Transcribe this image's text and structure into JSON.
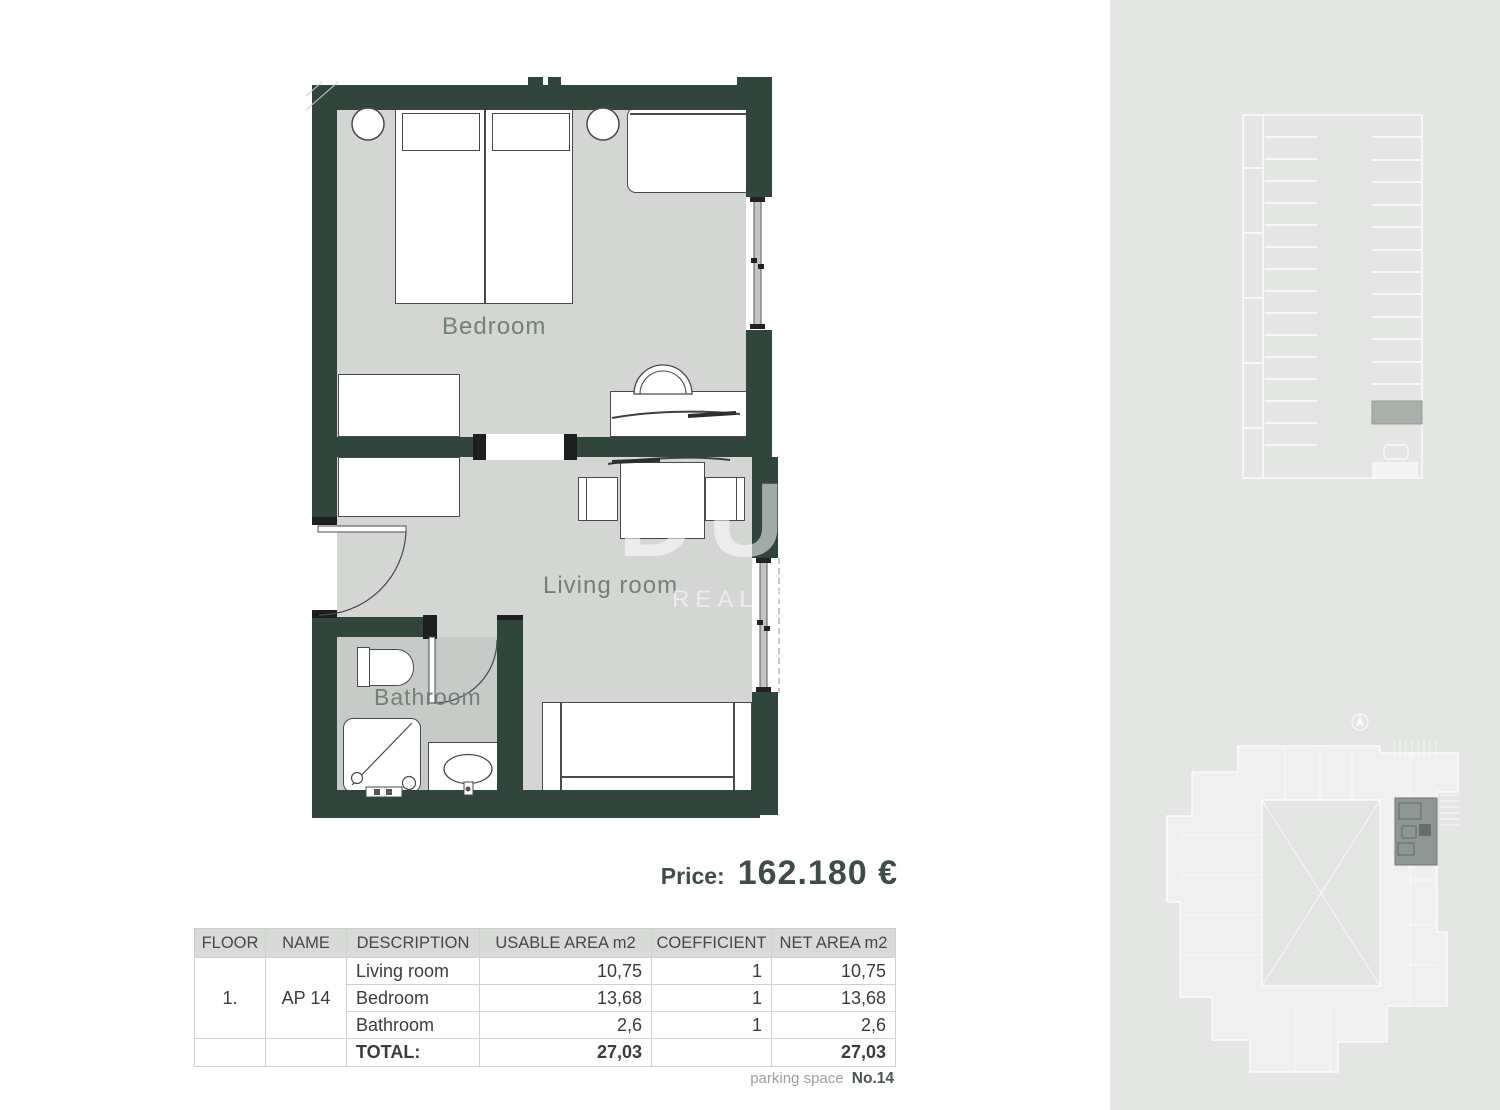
{
  "plan": {
    "bedroom_label": "Bedroom",
    "living_label": "Living room",
    "bathroom_label": "Bathroom"
  },
  "watermark": {
    "line1": "DUX",
    "line2": "REAL ESTATE"
  },
  "price": {
    "label": "Price:",
    "value": "162.180 €"
  },
  "table": {
    "headers": [
      "FLOOR",
      "NAME",
      "DESCRIPTION",
      "USABLE AREA m2",
      "COEFFICIENT",
      "NET AREA m2"
    ],
    "floor": "1.",
    "name": "AP 14",
    "rows": [
      {
        "description": "Living room",
        "usable": "10,75",
        "coefficient": "1",
        "net": "10,75"
      },
      {
        "description": "Bedroom",
        "usable": "13,68",
        "coefficient": "1",
        "net": "13,68"
      },
      {
        "description": "Bathroom",
        "usable": "2,6",
        "coefficient": "1",
        "net": "2,6"
      }
    ],
    "total": {
      "label": "TOTAL:",
      "usable": "27,03",
      "net": "27,03"
    }
  },
  "footer": {
    "parking_label": "parking space",
    "parking_value": "No.14"
  },
  "colors": {
    "wall": "#30463c",
    "floor": "#d3d6d3",
    "bathroom_floor": "#c7cbc8",
    "side_panel": "#e4e6e4",
    "parking_highlight": "#a8b0ac",
    "unit_highlight": "#8d9793",
    "room_label": "#72817a",
    "price_text": "#3e4d45"
  }
}
